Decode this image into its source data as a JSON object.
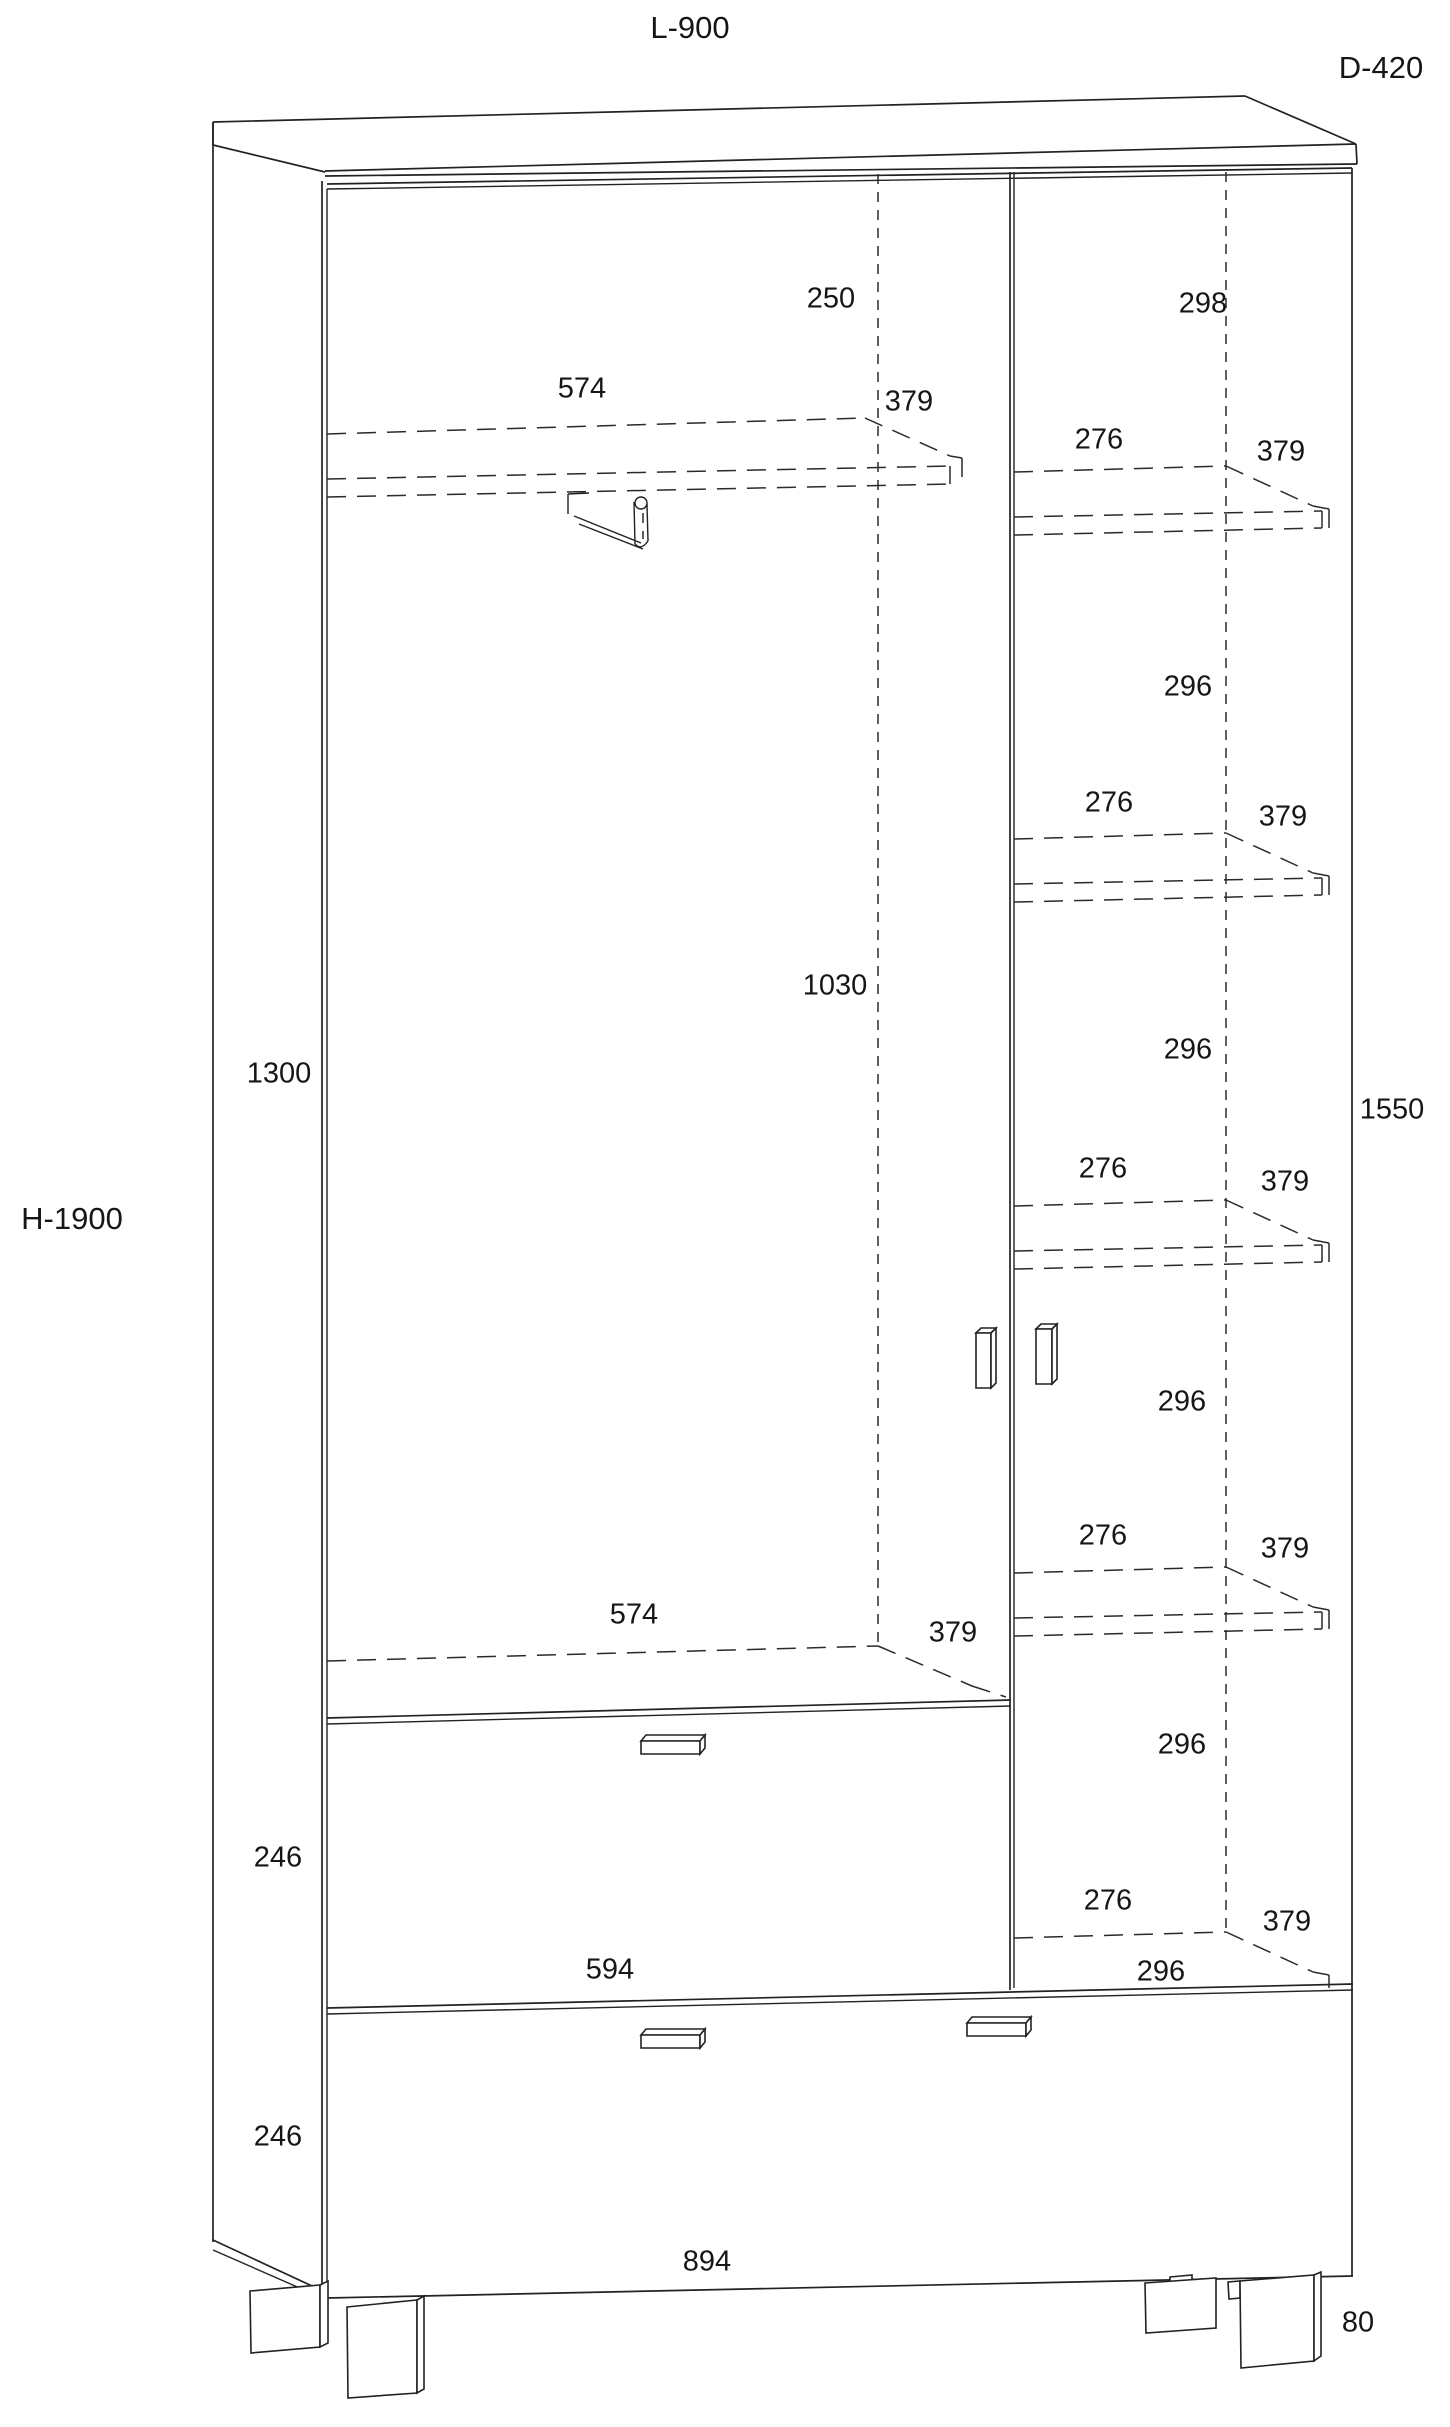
{
  "dims": {
    "overall_width": "L-900",
    "overall_depth": "D-420",
    "overall_height": "H-1900",
    "left_top_gap": "250",
    "right_top_gap": "298",
    "left_shelf_top_width": "574",
    "left_shelf_top_depth": "379",
    "right_shelf1_width": "276",
    "right_shelf1_depth": "379",
    "right_gap1": "296",
    "right_shelf2_width": "276",
    "right_shelf2_depth": "379",
    "right_gap2": "296",
    "left_hanging_height": "1030",
    "left_door_height": "1300",
    "right_door_height": "1550",
    "right_shelf3_width": "276",
    "right_shelf3_depth": "379",
    "right_gap3": "296",
    "right_shelf4_width": "276",
    "right_shelf4_depth": "379",
    "right_gap4": "296",
    "left_shelf_bottom_width": "574",
    "left_shelf_bottom_depth": "379",
    "drawer1_height": "246",
    "right_shelf5_width": "276",
    "right_shelf5_depth": "379",
    "drawer1_width": "594",
    "right_bottom_width": "296",
    "drawer2_height": "246",
    "drawer2_width": "894",
    "feet_height": "80"
  }
}
